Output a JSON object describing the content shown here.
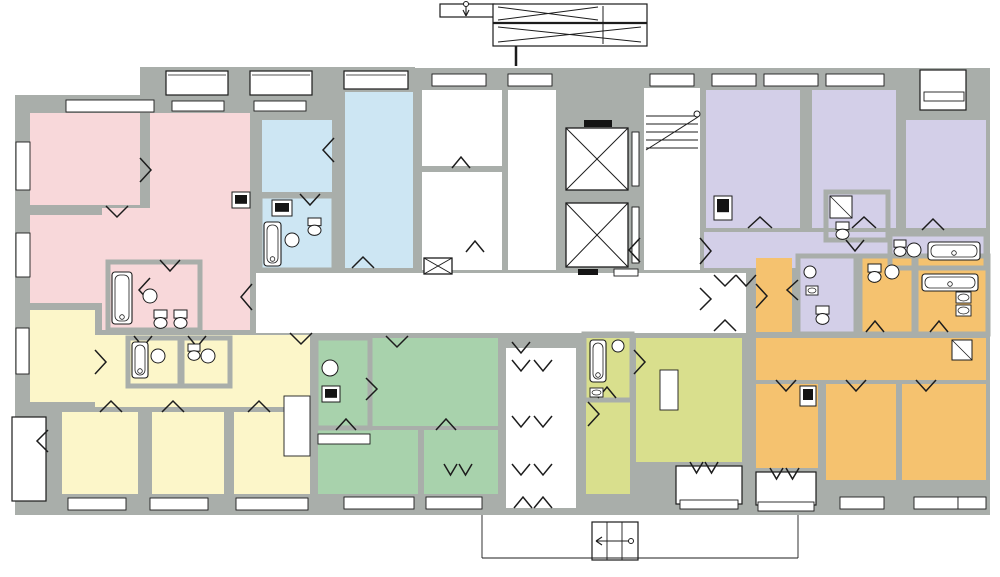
{
  "plan": {
    "description": "residential-floor-plan",
    "canvas": {
      "w": 1000,
      "h": 577
    },
    "palette": {
      "wall": "#a9aeaa",
      "line": "#1c1c1c",
      "white": "#ffffff",
      "pink": "#f8d8da",
      "blue": "#cde6f3",
      "lavender": "#d3cfe8",
      "yellow": "#fcf6c9",
      "green": "#a8d2ac",
      "lime": "#d9df8d",
      "orange": "#f5c26f",
      "dark": "#141414"
    },
    "slabs": [
      [
        15,
        95,
        400,
        420
      ],
      [
        415,
        68,
        575,
        447
      ],
      [
        140,
        67,
        275,
        30
      ]
    ],
    "whites": [
      [
        256,
        273,
        490,
        60
      ],
      [
        508,
        90,
        48,
        180
      ],
      [
        422,
        90,
        80,
        76
      ],
      [
        422,
        172,
        80,
        98
      ],
      [
        644,
        88,
        56,
        182
      ],
      [
        506,
        348,
        70,
        160
      ]
    ],
    "rooms": {
      "pink": [
        [
          30,
          113,
          110,
          92
        ],
        [
          30,
          215,
          72,
          88
        ],
        [
          150,
          113,
          100,
          217
        ],
        [
          102,
          208,
          48,
          122
        ]
      ],
      "blue": [
        [
          262,
          120,
          70,
          72
        ],
        [
          262,
          198,
          70,
          70
        ],
        [
          345,
          92,
          68,
          176
        ]
      ],
      "lavender": [
        [
          706,
          90,
          94,
          138
        ],
        [
          812,
          90,
          84,
          138
        ],
        [
          906,
          120,
          80,
          108
        ],
        [
          704,
          232,
          282,
          36
        ],
        [
          800,
          258,
          54,
          74
        ]
      ],
      "yellow": [
        [
          30,
          310,
          65,
          92
        ],
        [
          95,
          335,
          215,
          72
        ],
        [
          62,
          412,
          76,
          82
        ],
        [
          152,
          412,
          72,
          82
        ],
        [
          234,
          412,
          76,
          82
        ]
      ],
      "green": [
        [
          318,
          340,
          50,
          86
        ],
        [
          372,
          338,
          126,
          88
        ],
        [
          318,
          430,
          100,
          64
        ],
        [
          424,
          430,
          74,
          64
        ]
      ],
      "lime": [
        [
          586,
          338,
          44,
          60
        ],
        [
          586,
          402,
          44,
          92
        ],
        [
          636,
          338,
          106,
          124
        ]
      ],
      "orange": [
        [
          756,
          258,
          36,
          74
        ],
        [
          862,
          258,
          50,
          74
        ],
        [
          918,
          258,
          68,
          74
        ],
        [
          756,
          338,
          230,
          42
        ],
        [
          756,
          384,
          62,
          84
        ],
        [
          826,
          384,
          70,
          96
        ],
        [
          902,
          384,
          84,
          96
        ]
      ]
    },
    "outlined": [
      [
        166,
        71,
        62,
        24
      ],
      [
        250,
        71,
        62,
        24
      ],
      [
        344,
        71,
        64,
        18
      ],
      [
        920,
        70,
        46,
        40
      ],
      [
        12,
        417,
        34,
        84
      ],
      [
        756,
        472,
        60,
        33
      ],
      [
        676,
        466,
        66,
        38
      ],
      [
        440,
        4,
        54,
        13
      ],
      [
        493,
        4,
        154,
        42
      ],
      [
        592,
        522,
        46,
        38
      ]
    ],
    "windows": [
      [
        66,
        100,
        88,
        12
      ],
      [
        172,
        101,
        52,
        10
      ],
      [
        254,
        101,
        52,
        10
      ],
      [
        432,
        74,
        54,
        12
      ],
      [
        508,
        74,
        44,
        12
      ],
      [
        650,
        74,
        44,
        12
      ],
      [
        712,
        74,
        44,
        12
      ],
      [
        764,
        74,
        54,
        12
      ],
      [
        826,
        74,
        58,
        12
      ],
      [
        924,
        92,
        40,
        9
      ],
      [
        16,
        142,
        14,
        48
      ],
      [
        16,
        233,
        14,
        44
      ],
      [
        16,
        328,
        13,
        46
      ],
      [
        68,
        498,
        58,
        12
      ],
      [
        150,
        498,
        58,
        12
      ],
      [
        236,
        498,
        72,
        12
      ],
      [
        344,
        497,
        70,
        12
      ],
      [
        426,
        497,
        56,
        12
      ],
      [
        680,
        500,
        58,
        9
      ],
      [
        758,
        502,
        56,
        9
      ],
      [
        840,
        497,
        44,
        12
      ],
      [
        914,
        497,
        44,
        12
      ],
      [
        958,
        497,
        28,
        12
      ],
      [
        632,
        132,
        7,
        54
      ],
      [
        632,
        207,
        7,
        56
      ],
      [
        614,
        269,
        24,
        7
      ]
    ],
    "cells": [
      [
        108,
        262,
        92,
        68
      ],
      [
        260,
        196,
        74,
        74
      ],
      [
        826,
        192,
        62,
        48
      ],
      [
        890,
        234,
        96,
        34
      ],
      [
        798,
        256,
        58,
        78
      ],
      [
        128,
        338,
        52,
        48
      ],
      [
        182,
        338,
        48,
        48
      ],
      [
        584,
        334,
        48,
        66
      ],
      [
        860,
        256,
        54,
        78
      ],
      [
        916,
        256,
        72,
        78
      ],
      [
        316,
        338,
        54,
        90
      ]
    ],
    "xboxes": [
      [
        566,
        128,
        62,
        62
      ],
      [
        566,
        203,
        62,
        64
      ],
      [
        424,
        258,
        28,
        16
      ]
    ],
    "lines": [
      [
        168,
        75,
        226,
        75,
        0.8
      ],
      [
        252,
        75,
        310,
        75,
        0.8
      ],
      [
        346,
        75,
        406,
        75,
        0.8
      ],
      [
        646,
        116,
        698,
        116,
        1
      ],
      [
        646,
        124,
        698,
        124,
        1
      ],
      [
        646,
        132,
        698,
        132,
        1
      ],
      [
        646,
        140,
        698,
        140,
        1
      ],
      [
        646,
        148,
        698,
        148,
        1
      ],
      [
        646,
        150,
        698,
        117,
        1
      ],
      [
        493,
        23,
        647,
        23,
        2.2
      ],
      [
        603,
        6,
        603,
        44,
        1
      ],
      [
        498,
        7,
        598,
        20,
        1
      ],
      [
        598,
        7,
        498,
        20,
        1
      ],
      [
        498,
        27,
        641,
        42,
        1
      ],
      [
        641,
        27,
        498,
        42,
        1
      ],
      [
        516,
        46,
        516,
        66,
        2.5
      ],
      [
        466,
        5,
        466,
        15,
        1.1
      ],
      [
        463,
        10,
        466,
        16,
        1.1
      ],
      [
        469,
        10,
        466,
        16,
        1.1
      ],
      [
        482,
        515,
        482,
        558,
        0.9
      ],
      [
        482,
        558,
        798,
        558,
        0.9
      ],
      [
        798,
        558,
        798,
        515,
        0.9
      ],
      [
        607,
        522,
        607,
        560,
        0.9
      ],
      [
        622,
        522,
        622,
        560,
        0.9
      ],
      [
        596,
        541,
        630,
        541,
        1.1
      ],
      [
        602,
        537,
        596,
        541,
        1.1
      ],
      [
        602,
        545,
        596,
        541,
        1.1
      ],
      [
        286,
        398,
        308,
        418,
        1
      ],
      [
        322,
        440,
        366,
        440,
        0.9
      ]
    ],
    "doors": [
      [
        252,
        284,
        26,
        "l"
      ],
      [
        140,
        158,
        24,
        "r"
      ],
      [
        106,
        206,
        22,
        "d"
      ],
      [
        150,
        278,
        24,
        "l"
      ],
      [
        160,
        260,
        20,
        "d"
      ],
      [
        334,
        138,
        24,
        "l"
      ],
      [
        300,
        194,
        20,
        "d"
      ],
      [
        352,
        268,
        22,
        "u"
      ],
      [
        452,
        168,
        18,
        "u"
      ],
      [
        466,
        252,
        18,
        "u"
      ],
      [
        640,
        238,
        24,
        "l"
      ],
      [
        700,
        238,
        26,
        "r"
      ],
      [
        748,
        228,
        24,
        "u"
      ],
      [
        852,
        228,
        24,
        "u"
      ],
      [
        922,
        230,
        22,
        "u"
      ],
      [
        846,
        240,
        18,
        "d"
      ],
      [
        798,
        280,
        20,
        "l"
      ],
      [
        290,
        333,
        22,
        "d"
      ],
      [
        95,
        350,
        24,
        "r"
      ],
      [
        134,
        336,
        18,
        "d"
      ],
      [
        188,
        336,
        18,
        "d"
      ],
      [
        100,
        412,
        22,
        "u"
      ],
      [
        162,
        412,
        22,
        "u"
      ],
      [
        248,
        412,
        22,
        "u"
      ],
      [
        48,
        430,
        22,
        "l"
      ],
      [
        386,
        336,
        22,
        "d"
      ],
      [
        366,
        378,
        22,
        "r"
      ],
      [
        336,
        430,
        20,
        "u"
      ],
      [
        436,
        430,
        20,
        "u"
      ],
      [
        444,
        464,
        13,
        "d"
      ],
      [
        459,
        464,
        13,
        "d"
      ],
      [
        588,
        402,
        24,
        "r"
      ],
      [
        598,
        398,
        18,
        "u"
      ],
      [
        634,
        350,
        24,
        "r"
      ],
      [
        690,
        462,
        13,
        "d"
      ],
      [
        705,
        462,
        13,
        "d"
      ],
      [
        756,
        284,
        24,
        "r"
      ],
      [
        776,
        380,
        20,
        "d"
      ],
      [
        846,
        380,
        20,
        "d"
      ],
      [
        916,
        380,
        20,
        "d"
      ],
      [
        866,
        332,
        18,
        "u"
      ],
      [
        930,
        332,
        18,
        "u"
      ],
      [
        770,
        468,
        13,
        "d"
      ],
      [
        786,
        468,
        13,
        "d"
      ],
      [
        700,
        288,
        22,
        "r"
      ],
      [
        714,
        275,
        22,
        "d"
      ],
      [
        714,
        331,
        22,
        "u"
      ],
      [
        736,
        275,
        20,
        "d"
      ],
      [
        512,
        342,
        18,
        "d"
      ],
      [
        512,
        360,
        18,
        "d"
      ],
      [
        534,
        360,
        18,
        "d"
      ],
      [
        512,
        416,
        18,
        "d"
      ],
      [
        534,
        416,
        18,
        "d"
      ],
      [
        512,
        464,
        18,
        "d"
      ],
      [
        534,
        464,
        18,
        "d"
      ],
      [
        514,
        508,
        18,
        "u"
      ],
      [
        534,
        508,
        18,
        "u"
      ]
    ],
    "fixtures": {
      "tubs": [
        [
          112,
          272,
          20,
          52
        ],
        [
          264,
          222,
          17,
          44
        ],
        [
          132,
          342,
          16,
          36
        ],
        [
          590,
          340,
          16,
          42
        ],
        [
          928,
          242,
          52,
          18
        ],
        [
          922,
          274,
          56,
          17
        ]
      ],
      "toilets": [
        [
          154,
          310,
          13,
          18
        ],
        [
          174,
          310,
          13,
          18
        ],
        [
          308,
          218,
          13,
          17
        ],
        [
          836,
          222,
          13,
          17
        ],
        [
          894,
          240,
          12,
          16
        ],
        [
          816,
          306,
          13,
          18
        ],
        [
          188,
          344,
          12,
          16
        ],
        [
          868,
          264,
          13,
          18
        ]
      ],
      "sinks": [
        [
          150,
          296,
          7
        ],
        [
          292,
          240,
          7
        ],
        [
          158,
          356,
          7
        ],
        [
          208,
          356,
          7
        ],
        [
          330,
          368,
          8
        ],
        [
          618,
          346,
          6
        ],
        [
          914,
          250,
          7
        ],
        [
          810,
          272,
          6
        ],
        [
          892,
          272,
          7
        ],
        [
          697,
          114,
          3
        ],
        [
          466,
          4,
          2.5
        ],
        [
          631,
          541,
          2.5
        ]
      ],
      "washers": [
        [
          232,
          192,
          18,
          16
        ],
        [
          272,
          200,
          20,
          16
        ],
        [
          714,
          196,
          18,
          24
        ],
        [
          322,
          386,
          18,
          16
        ],
        [
          800,
          386,
          16,
          20
        ]
      ],
      "showers": [
        [
          830,
          196,
          22,
          22
        ],
        [
          952,
          340,
          20,
          20
        ]
      ],
      "sinkrects": [
        [
          590,
          388,
          13,
          9
        ],
        [
          956,
          292,
          15,
          11
        ],
        [
          956,
          305,
          15,
          11
        ],
        [
          806,
          286,
          12,
          9
        ]
      ],
      "darks": [
        [
          584,
          120,
          28,
          7
        ],
        [
          578,
          269,
          20,
          6
        ],
        [
          288,
          428,
          18,
          9
        ],
        [
          288,
          440,
          18,
          9
        ],
        [
          663,
          374,
          12,
          12
        ]
      ],
      "counters": [
        [
          284,
          396,
          26,
          60
        ],
        [
          318,
          434,
          52,
          10
        ],
        [
          660,
          370,
          18,
          40
        ]
      ]
    }
  }
}
